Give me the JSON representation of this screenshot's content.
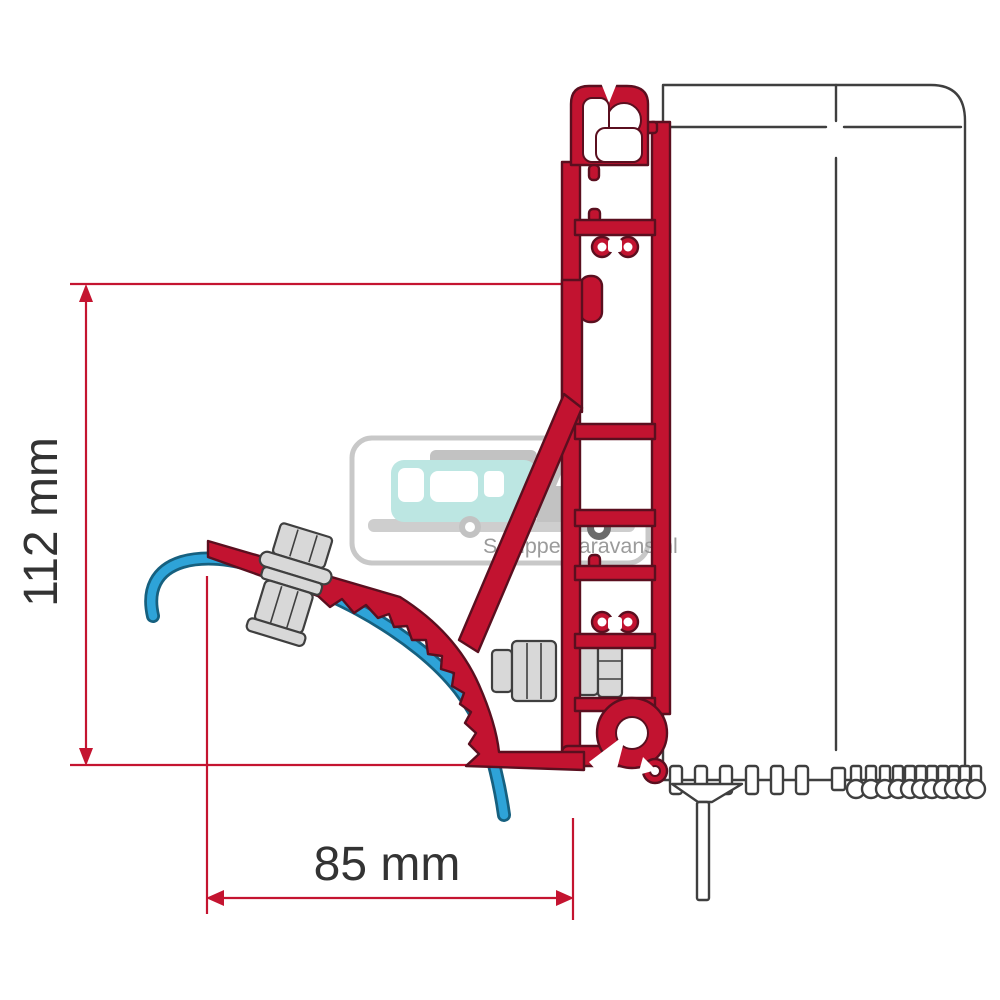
{
  "dimensions": {
    "height": {
      "label": "112 mm",
      "orientation": "vertical"
    },
    "width": {
      "label": "85 mm",
      "orientation": "horizontal"
    }
  },
  "watermark": {
    "text": "Schippercaravans.nl"
  },
  "colors": {
    "red": "#C21330",
    "redDark": "#5A0F1F",
    "dim": "#C41430",
    "text": "#333333",
    "blue": "#2EA3D8",
    "blueDark": "#16607F",
    "steel": "#D8D8D8",
    "steelDark": "#3F3F3F",
    "case": "#3F3F3F",
    "teal": "#BCE6E2",
    "silGray": "#C2C2C2",
    "wmText": "#9B9B9B",
    "wmBorder": "#C8C8C8",
    "headlight": "#EDC937",
    "wheelDark": "#6A6A6A"
  }
}
